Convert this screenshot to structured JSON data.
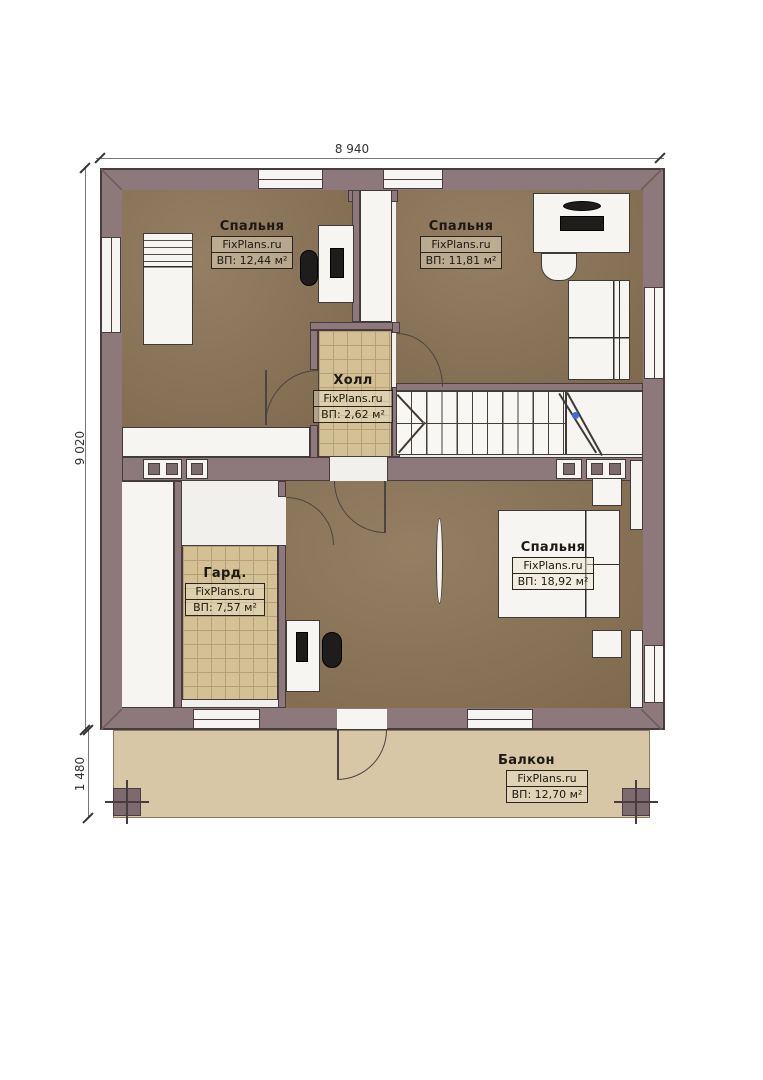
{
  "plan_title": "floor-plan-level-2",
  "dimensions": {
    "top": "8 940",
    "side": "9 020",
    "balcony": "1 480"
  },
  "rooms": [
    {
      "id": "bedroom-top-left",
      "name": "Спальня",
      "watermark": "FixPlans.ru",
      "area": "ВП: 12,44 м²"
    },
    {
      "id": "bedroom-top-right",
      "name": "Спальня",
      "watermark": "FixPlans.ru",
      "area": "ВП: 11,81 м²"
    },
    {
      "id": "hall",
      "name": "Холл",
      "watermark": "FixPlans.ru",
      "area": "ВП: 2,62 м²"
    },
    {
      "id": "wardrobe",
      "name": "Гард.",
      "watermark": "FixPlans.ru",
      "area": "ВП: 7,57 м²"
    },
    {
      "id": "bedroom-bottom",
      "name": "Спальня",
      "watermark": "FixPlans.ru",
      "area": "ВП: 18,92 м²"
    },
    {
      "id": "balcony",
      "name": "Балкон",
      "watermark": "FixPlans.ru",
      "area": "ВП: 12,70 м²"
    }
  ],
  "colors": {
    "wall": "#8d797c",
    "floor_brown": "#8d7557",
    "floor_grid": "#d3c095",
    "balcony_floor": "#d7c7a6",
    "outline": "#483c3f",
    "stair_marker_blue": "#3a6fd8"
  }
}
